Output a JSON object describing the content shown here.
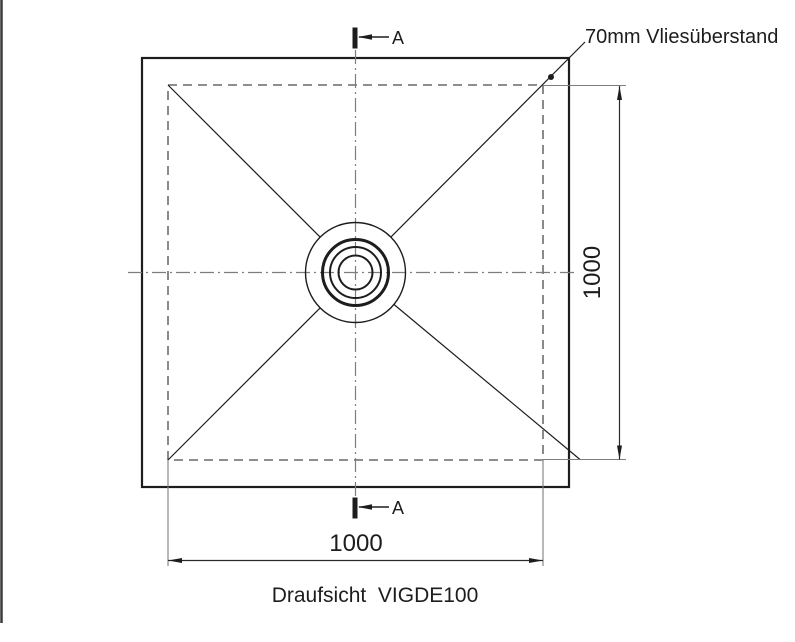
{
  "page": {
    "background": "#ffffff",
    "edge_color": "#3a3a3a"
  },
  "drawing": {
    "caption": "Draufsicht  VIGDE100",
    "annotation": "70mm Vliesüberstand",
    "dimensions": {
      "width_label": "1000",
      "height_label": "1000"
    },
    "section_markers": {
      "top": "A",
      "bottom": "A"
    },
    "colors": {
      "ink": "#1d1d1d",
      "aux_gray": "#7e7e7e",
      "dim_line": "#2a2a2a"
    }
  }
}
